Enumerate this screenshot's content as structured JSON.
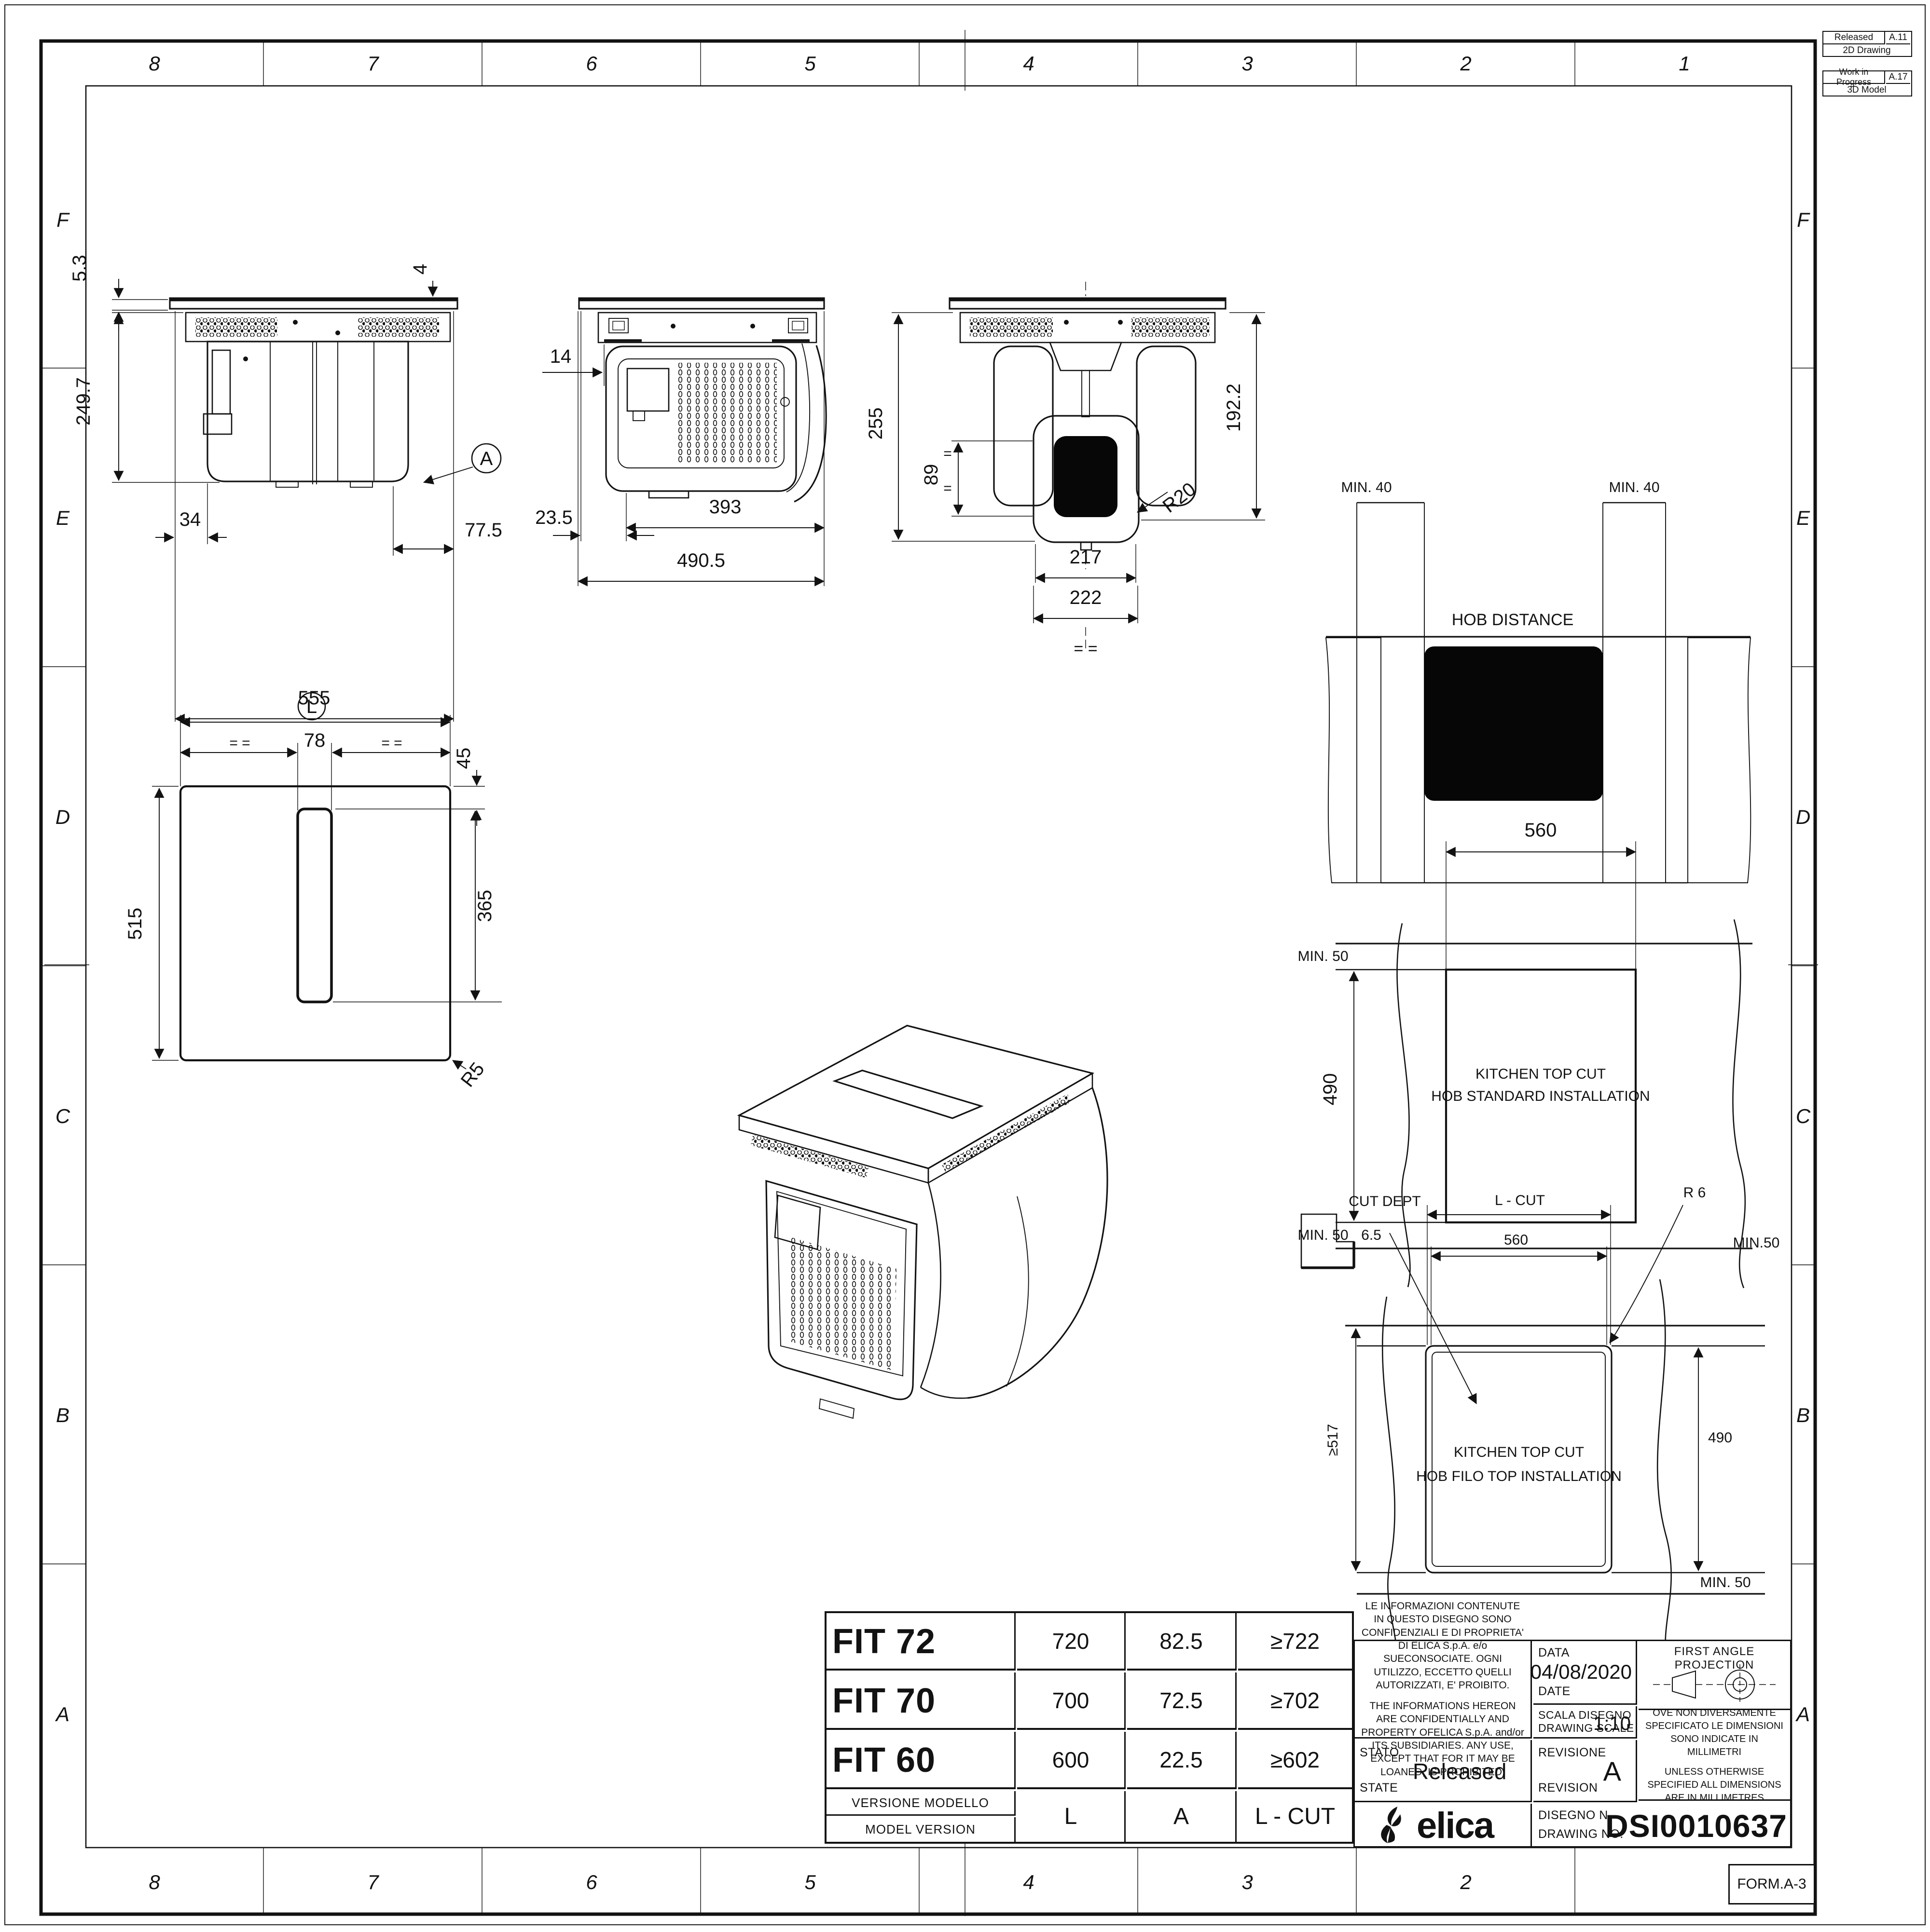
{
  "sheet": {
    "form_label": "FORM.A-3",
    "grid_cols": [
      "8",
      "7",
      "6",
      "5",
      "4",
      "3",
      "2",
      "1"
    ],
    "grid_rows": [
      "F",
      "E",
      "D",
      "C",
      "B",
      "A"
    ],
    "revision_history": [
      {
        "status": "Released",
        "revision": "A.11",
        "kind": "2D Drawing"
      },
      {
        "status": "Work in Progress",
        "revision": "A.17",
        "kind": "3D Model"
      }
    ]
  },
  "front_view": {
    "thickness": "5.3",
    "overhang": "4",
    "height": "249.7",
    "offset_left": "34",
    "offset_right": "77.5",
    "width": "555",
    "detail": "A"
  },
  "side_view": {
    "offset_front": "14",
    "offset_left": "23.5",
    "body_width": "393",
    "total_width": "490.5"
  },
  "rear_view": {
    "height": "255",
    "duct_center": "89",
    "body_height": "192.2",
    "outlet_width": "217",
    "outlet_outer": "222",
    "radius": "R20",
    "equals": "=  =",
    "equal_mark": "="
  },
  "plan_view": {
    "balloon": "L",
    "slot_width": "78",
    "slot_offset": "45",
    "depth": "515",
    "slot_length": "365",
    "radius": "R5",
    "equals": "=  ="
  },
  "hob_distance_view": {
    "title": "HOB DISTANCE",
    "min_left": "MIN. 40",
    "min_right": "MIN. 40"
  },
  "standard_cut_view": {
    "width": "560",
    "depth": "490",
    "min_top": "MIN. 50",
    "min_bottom": "MIN. 50",
    "caption_line1": "KITCHEN TOP CUT",
    "caption_line2": "HOB STANDARD INSTALLATION"
  },
  "filo_cut_view": {
    "cut_dept_label": "CUT DEPT",
    "cut_dept_value": "6.5",
    "lcut": "L - CUT",
    "width": "560",
    "radius": "R 6",
    "min_top": "MIN.50",
    "depth": "490",
    "min_depth": "≥517",
    "min_bottom": "MIN. 50",
    "caption_line1": "KITCHEN TOP CUT",
    "caption_line2": "HOB FILO TOP INSTALLATION"
  },
  "model_table": {
    "rows": [
      {
        "model": "FIT 72",
        "l": "720",
        "a": "82.5",
        "lcut": "≥722"
      },
      {
        "model": "FIT 70",
        "l": "700",
        "a": "72.5",
        "lcut": "≥702"
      },
      {
        "model": "FIT 60",
        "l": "600",
        "a": "22.5",
        "lcut": "≥602"
      }
    ],
    "footer_label_it": "VERSIONE MODELLO",
    "footer_label_en": "MODEL VERSION",
    "col_l": "L",
    "col_a": "A",
    "col_lcut": "L - CUT"
  },
  "title_block": {
    "disclaimer_it": "LE INFORMAZIONI CONTENUTE IN QUESTO DISEGNO SONO CONFIDENZIALI E DI PROPRIETA' DI ELICA S.p.A. e/o SUECONSOCIATE. OGNI UTILIZZO, ECCETTO QUELLI AUTORIZZATI, E' PROIBITO.",
    "disclaimer_en": "THE INFORMATIONS HEREON ARE CONFIDENTIALLY AND PROPERTY OFELICA S.p.A.  and/or ITS SUBSIDIARIES. ANY USE, EXCEPT THAT FOR IT MAY BE LOANED, IS PROHIBITED.",
    "date_label_it": "DATA",
    "date_label_en": "DATE",
    "date": "04/08/2020",
    "scale_label_it": "SCALA DISEGNO",
    "scale_label_en": "DRAWING SCALE",
    "scale": "1:10",
    "state_label_it": "STATO",
    "state_label_en": "STATE",
    "state": "Released",
    "revision_label_it": "REVISIONE",
    "revision_label_en": "REVISION",
    "revision": "A",
    "drawing_label_it": "DISEGNO N.",
    "drawing_label_en": "DRAWING NO.",
    "drawing_no": "DSI0010637",
    "projection": "FIRST ANGLE PROJECTION",
    "units_it": "OVE NON DIVERSAMENTE SPECIFICATO LE DIMENSIONI SONO INDICATE IN MILLIMETRI",
    "units_en": "UNLESS OTHERWISE SPECIFIED ALL DIMENSIONS ARE IN MILLIMETRES",
    "brand": "elica"
  }
}
